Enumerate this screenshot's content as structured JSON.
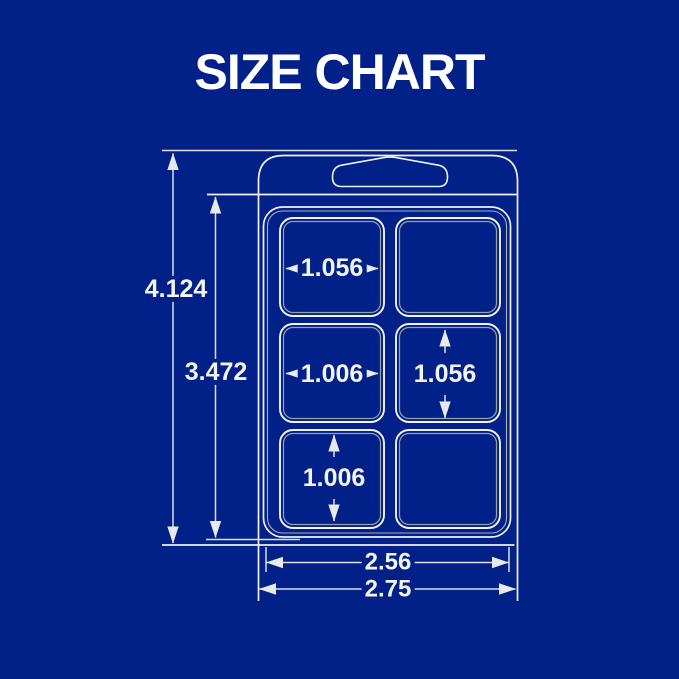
{
  "title": "SIZE CHART",
  "colors": {
    "background": "#012189",
    "outline": "#eef0f2",
    "inner_edge": "#9aa0a8",
    "dimension_line": "#dcdee0",
    "text": "#ffffff"
  },
  "diagram": {
    "subject": "6-cavity clamshell wax melt package",
    "cavity_rows": 3,
    "cavity_columns": 2
  },
  "dimensions": {
    "total_height": "4.124",
    "body_height": "3.472",
    "cavity_width_top": "1.056",
    "cavity_width_middle": "1.006",
    "cavity_height_middle": "1.056",
    "cavity_height_bottom": "1.006",
    "inner_width": "2.56",
    "total_width": "2.75"
  }
}
